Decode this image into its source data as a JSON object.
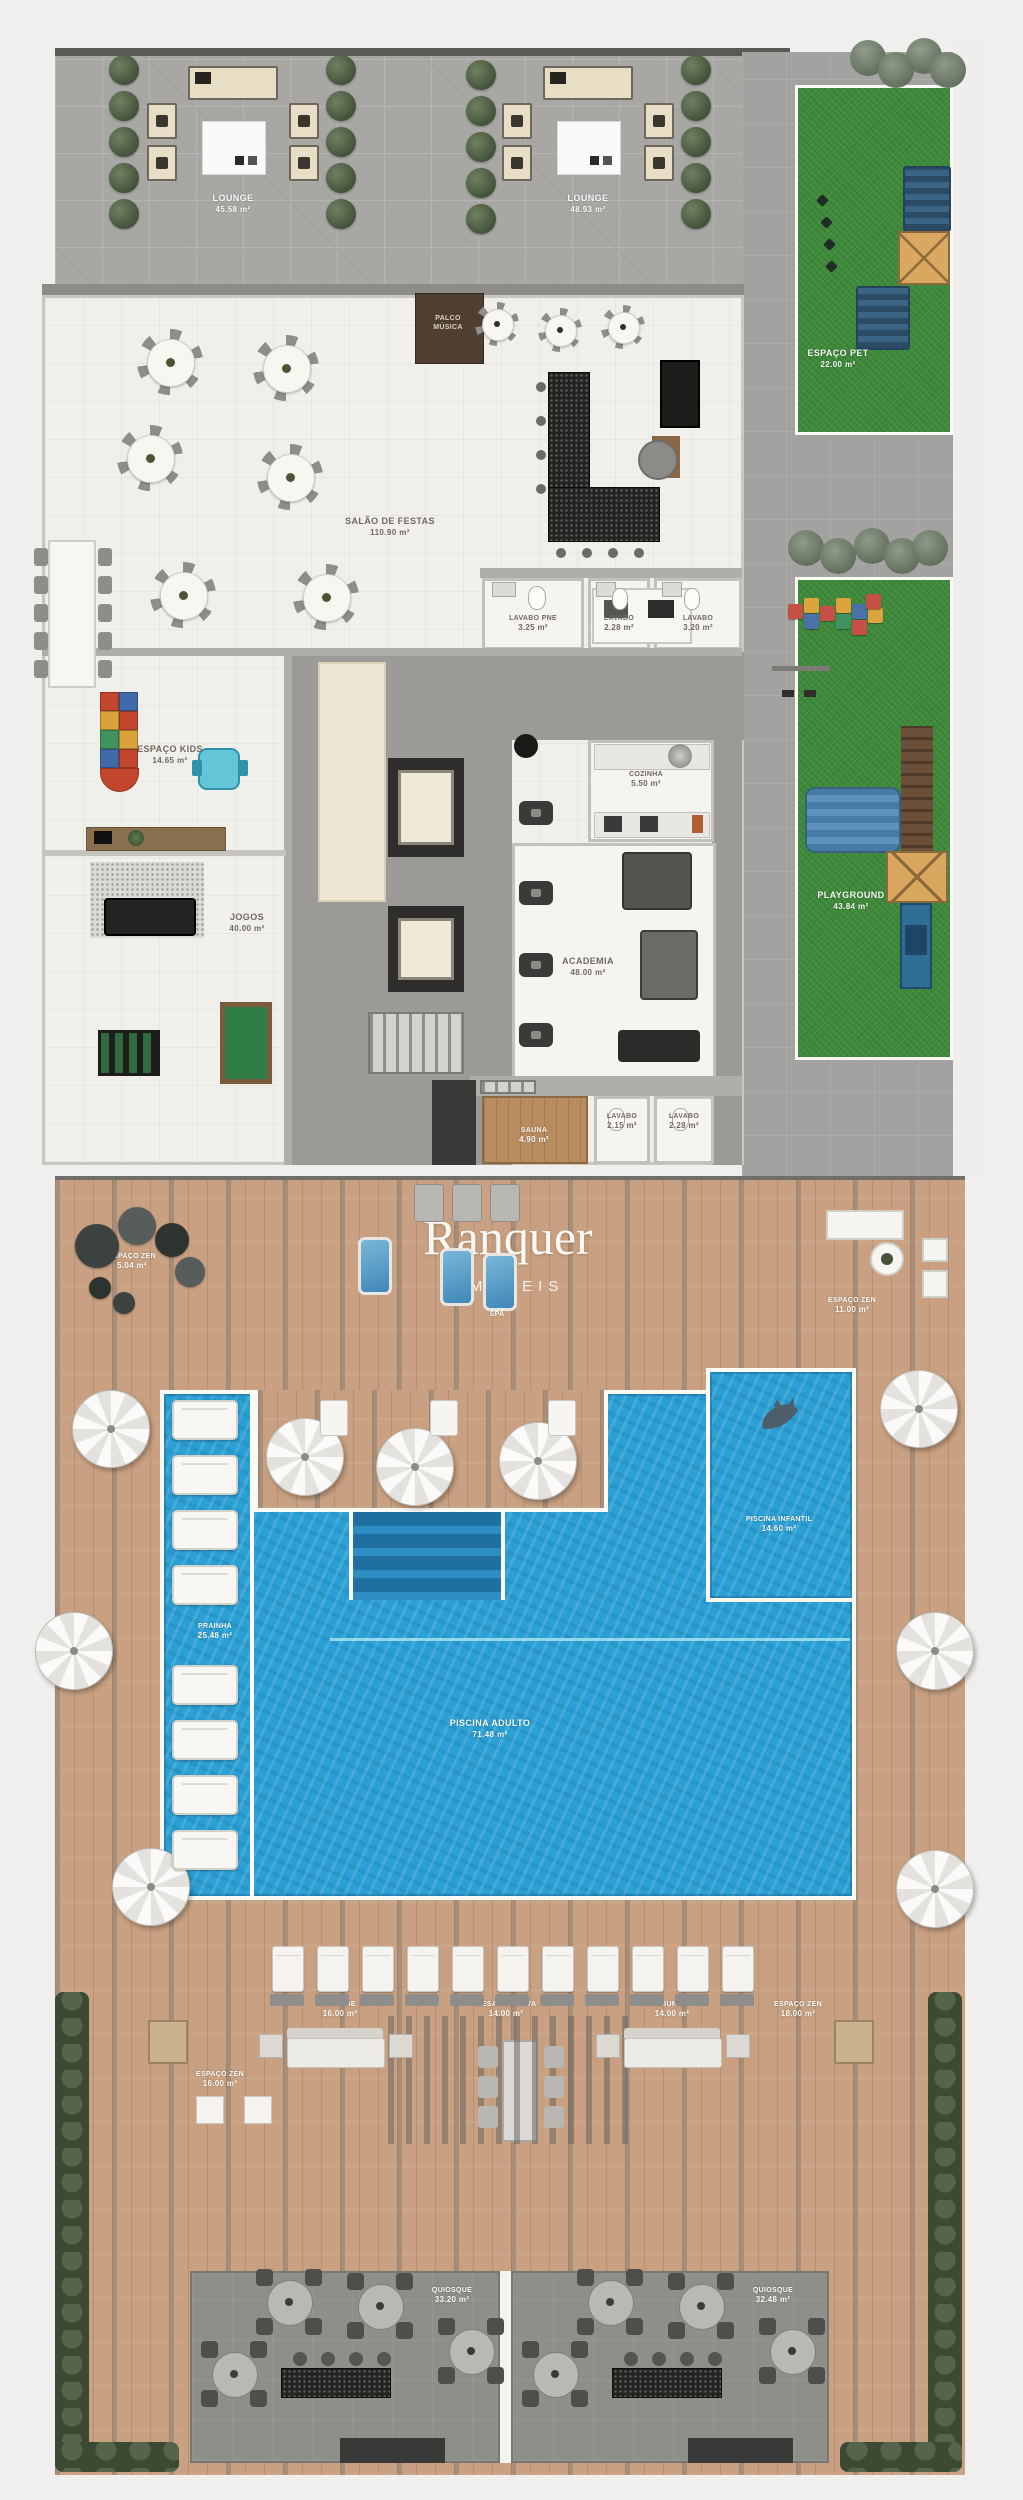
{
  "brand": {
    "name": "Ranquer",
    "type": "IMÓVEIS"
  },
  "areas": {
    "lounge_nw": {
      "name": "LOUNGE",
      "size": "45.58 m²"
    },
    "lounge_ne": {
      "name": "LOUNGE",
      "size": "48.93 m²"
    },
    "espaco_pet": {
      "name": "ESPAÇO PET",
      "size": "22.00 m²"
    },
    "salao_festas": {
      "name": "SALÃO DE FESTAS",
      "size": "110.90 m²"
    },
    "palco_musica": {
      "name": "PALCO MÚSICA",
      "size": ""
    },
    "lavabo_pne": {
      "name": "LAVABO PNE",
      "size": "3.25 m²"
    },
    "lavabo_1": {
      "name": "LAVABO",
      "size": "2.28 m²"
    },
    "lavabo_2": {
      "name": "LAVABO",
      "size": "3.20 m²"
    },
    "espaco_kids": {
      "name": "ESPAÇO KIDS",
      "size": "14.65 m²"
    },
    "jogos": {
      "name": "JOGOS",
      "size": "40.00 m²"
    },
    "cozinha": {
      "name": "COZINHA",
      "size": "5.50 m²"
    },
    "academia": {
      "name": "ACADEMIA",
      "size": "48.00 m²"
    },
    "playground": {
      "name": "PLAYGROUND",
      "size": "43.84 m²"
    },
    "sauna": {
      "name": "SAUNA",
      "size": "4.90 m²"
    },
    "lavabo_3": {
      "name": "LAVABO",
      "size": "2.15 m²"
    },
    "lavabo_4": {
      "name": "LAVABO",
      "size": "2.28 m²"
    },
    "zen_1": {
      "name": "ESPAÇO ZEN",
      "size": "5.04 m²"
    },
    "zen_2": {
      "name": "ESPAÇO ZEN",
      "size": "11.00 m²"
    },
    "spa": {
      "name": "SPA",
      "size": ""
    },
    "prainha": {
      "name": "PRAINHA",
      "size": "25.48 m²"
    },
    "piscina_infantil": {
      "name": "PISCINA INFANTIL",
      "size": "14.60 m²"
    },
    "piscina_adulto": {
      "name": "PISCINA ADULTO",
      "size": "71.48 m²"
    },
    "lounge_deck_1": {
      "name": "LOUNGE",
      "size": "16.00 m²"
    },
    "mesa_coletiva": {
      "name": "MESA COLETIVA",
      "size": "14.00 m²"
    },
    "lounge_deck_2": {
      "name": "LOUNGE",
      "size": "14.00 m²"
    },
    "zen_3": {
      "name": "ESPAÇO ZEN",
      "size": "18.00 m²"
    },
    "zen_4": {
      "name": "ESPAÇO ZEN",
      "size": "16.00 m²"
    },
    "quiosque_1": {
      "name": "QUIOSQUE",
      "size": "33.20 m²"
    },
    "quiosque_2": {
      "name": "QUIOSQUE",
      "size": "32.48 m²"
    }
  }
}
